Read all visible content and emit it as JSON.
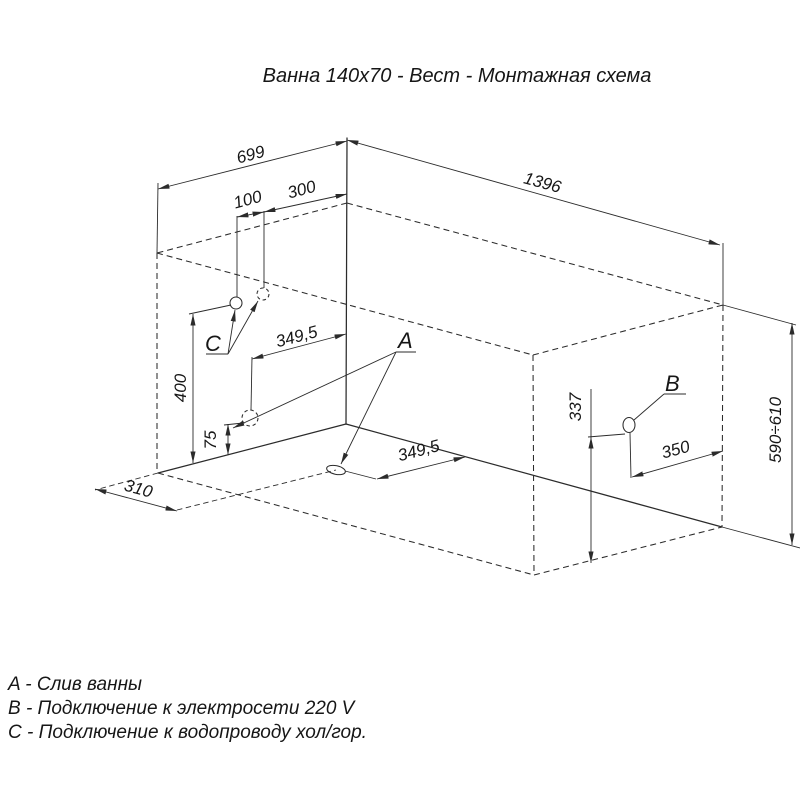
{
  "title": "Ванна 140x70 - Вест - Монтажная схема",
  "labels": {
    "a": "A",
    "b": "B",
    "c": "C"
  },
  "dims": {
    "top_width": "699",
    "top_length": "1396",
    "c_spacing": "100",
    "c_from_edge": "300",
    "drain_side_offset": "349,5",
    "drain_floor_offset": "349,5",
    "c_height": "400",
    "drain_height": "75",
    "drain_from_end": "310",
    "b_height": "337",
    "b_from_edge": "350",
    "total_height": "590÷610"
  },
  "legend": {
    "items": [
      {
        "text": "A - Слив ванны"
      },
      {
        "text": "B - Подключение к электросети 220 V"
      },
      {
        "text": "C - Подключение к водопроводу хол/гор."
      }
    ]
  }
}
